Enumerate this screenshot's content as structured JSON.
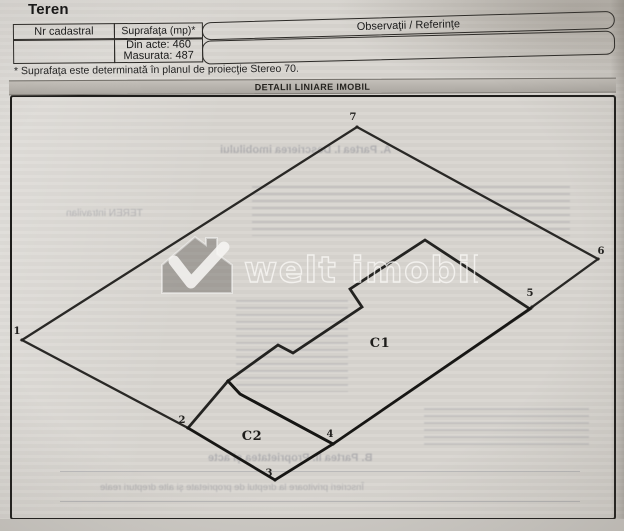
{
  "page": {
    "title": "Teren",
    "footnote": "* Suprafaţa este determinată în planul de proiecţie Stereo 70.",
    "section_header": "DETALII LINIARE IMOBIL",
    "colors": {
      "paper": "#d8d5d0",
      "line": "#1a1917",
      "section_bar": "#b5b1ab"
    }
  },
  "table": {
    "columns": [
      "Nr cadastral",
      "Suprafaţa (mp)*",
      "Observaţii / Referinţe"
    ],
    "rows": [
      {
        "nr_cadastral": "",
        "suprafata": [
          "Din acte: 460",
          "Masurata: 487"
        ],
        "observatii": ""
      }
    ]
  },
  "diagram": {
    "parcel": {
      "points": [
        [
          22,
          340
        ],
        [
          357,
          127
        ],
        [
          598,
          259
        ],
        [
          532,
          307
        ],
        [
          333,
          444
        ],
        [
          275,
          480
        ],
        [
          188,
          428
        ]
      ],
      "vertex_labels": [
        {
          "t": "1",
          "x": 17,
          "y": 334
        },
        {
          "t": "7",
          "x": 353,
          "y": 120
        },
        {
          "t": "6",
          "x": 601,
          "y": 254
        },
        {
          "t": "5",
          "x": 530,
          "y": 296
        },
        {
          "t": "4",
          "x": 330,
          "y": 437
        },
        {
          "t": "3",
          "x": 269,
          "y": 476
        },
        {
          "t": "2",
          "x": 182,
          "y": 423
        }
      ]
    },
    "buildings": [
      {
        "label": "C1",
        "label_x": 380,
        "label_y": 347,
        "points": [
          [
            425,
            240
          ],
          [
            530,
            309
          ],
          [
            333,
            444
          ],
          [
            240,
            394
          ],
          [
            228,
            381
          ],
          [
            278,
            345
          ],
          [
            293,
            353
          ],
          [
            362,
            307
          ],
          [
            350,
            289
          ]
        ]
      },
      {
        "label": "C2",
        "label_x": 252,
        "label_y": 440,
        "points": [
          [
            188,
            428
          ],
          [
            228,
            381
          ],
          [
            240,
            394
          ],
          [
            333,
            444
          ],
          [
            275,
            480
          ]
        ]
      }
    ]
  },
  "watermark": {
    "text": "welt imobiliare",
    "logo": "house-checkmark"
  },
  "bleedthrough": {
    "items": [
      {
        "kind": "text",
        "text": "A. Partea I. Descrierea imobilului",
        "x": 220,
        "y": 144,
        "size": 11,
        "bold": true
      },
      {
        "kind": "text",
        "text": "TEREN intravilan",
        "x": 66,
        "y": 208,
        "size": 10,
        "bold": false
      },
      {
        "kind": "stripes",
        "x": 252,
        "y": 186,
        "w": 318,
        "h": 50
      },
      {
        "kind": "stripes",
        "x": 236,
        "y": 300,
        "w": 112,
        "h": 92
      },
      {
        "kind": "stripes",
        "x": 424,
        "y": 408,
        "w": 165,
        "h": 42
      },
      {
        "kind": "text",
        "text": "B. Partea II. Proprietatea şi acte",
        "x": 208,
        "y": 452,
        "size": 11,
        "bold": true
      },
      {
        "kind": "text",
        "text": "Înscrieri privitoare la dreptul de proprietate şi alte drepturi reale",
        "x": 100,
        "y": 482,
        "size": 9.5,
        "bold": false
      },
      {
        "kind": "line",
        "x": 60,
        "y": 471,
        "w": 520
      },
      {
        "kind": "line",
        "x": 60,
        "y": 501,
        "w": 520
      }
    ]
  }
}
